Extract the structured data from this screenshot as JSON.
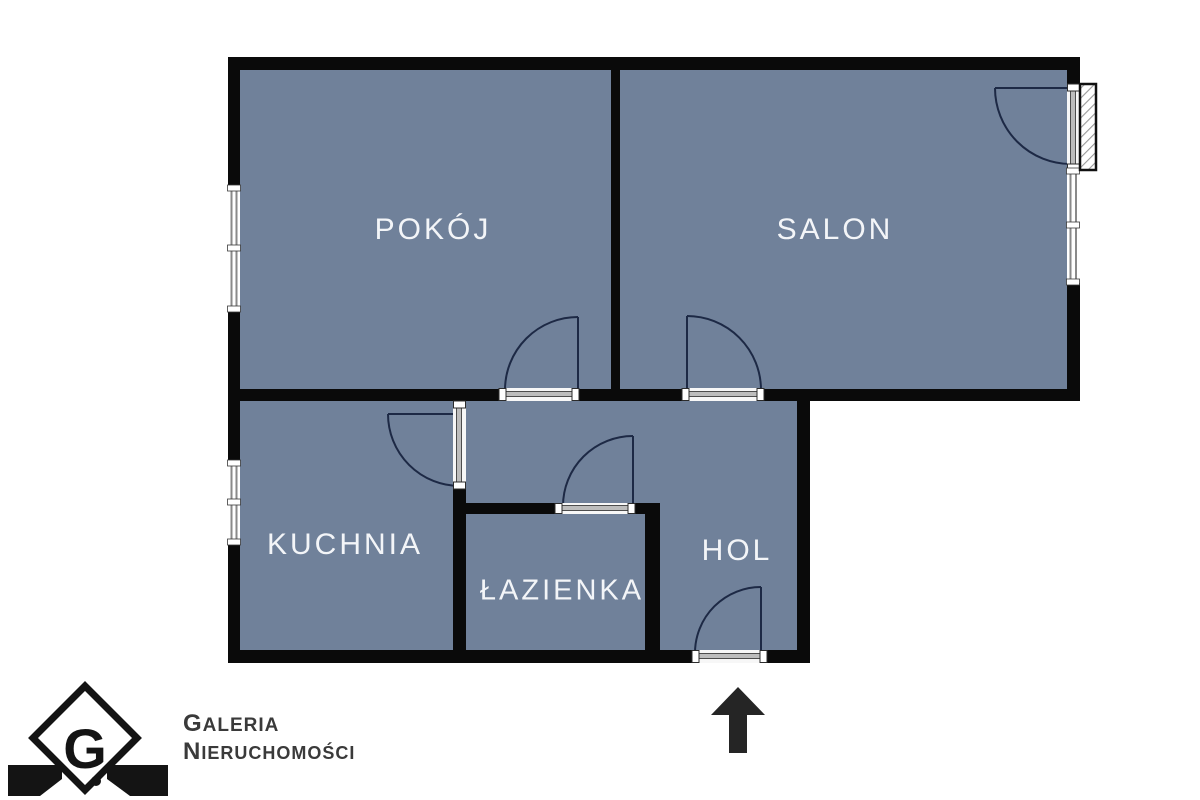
{
  "floor_plan": {
    "rooms": [
      {
        "id": "pokoj",
        "label": "POKÓJ"
      },
      {
        "id": "salon",
        "label": "SALON"
      },
      {
        "id": "kuchnia",
        "label": "KUCHNIA"
      },
      {
        "id": "lazienka",
        "label": "ŁAZIENKA"
      },
      {
        "id": "hol",
        "label": "HOL"
      }
    ],
    "colors": {
      "room_fill": "#70819a",
      "wall": "#0a0a0a",
      "door_arc": "#1d2945",
      "window_frame": "#8a8a8a",
      "entrance_arrow": "#252525"
    }
  },
  "branding": {
    "monogram": "G",
    "line1": "GALERIA",
    "line2": "NIERUCHOMOŚCI",
    "text_color": "#3a3a3a"
  }
}
